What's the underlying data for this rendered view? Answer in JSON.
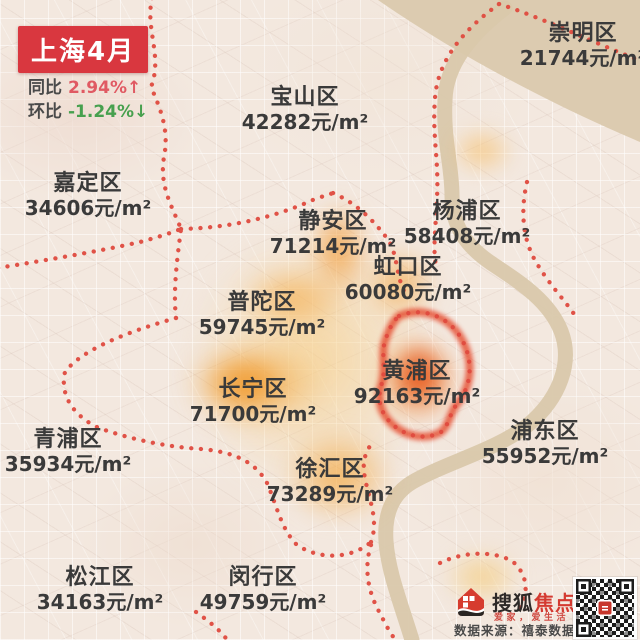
{
  "header": {
    "title": "上海4月",
    "yoy_label": "同比",
    "yoy_value": "2.94%↑",
    "mom_label": "环比",
    "mom_value": "-1.24%↓",
    "title_bg_color": "#d9373f",
    "yoy_color": "#e05a63",
    "mom_color": "#47a04e"
  },
  "map": {
    "unit": "元/m²",
    "boundary_dot_color": "#e04b3f",
    "heat_color": "#f0962e",
    "highlight_color": "#e5472a",
    "river_color": "#dccbb0",
    "districts": [
      {
        "name": "崇明区",
        "price": "21744元/m²"
      },
      {
        "name": "宝山区",
        "price": "42282元/m²"
      },
      {
        "name": "嘉定区",
        "price": "34606元/m²"
      },
      {
        "name": "静安区",
        "price": "71214元/m²"
      },
      {
        "name": "杨浦区",
        "price": "58408元/m²"
      },
      {
        "name": "虹口区",
        "price": "60080元/m²"
      },
      {
        "name": "普陀区",
        "price": "59745元/m²"
      },
      {
        "name": "黄浦区",
        "price": "92163元/m²"
      },
      {
        "name": "长宁区",
        "price": "71700元/m²"
      },
      {
        "name": "青浦区",
        "price": "35934元/m²"
      },
      {
        "name": "浦东区",
        "price": "55952元/m²"
      },
      {
        "name": "徐汇区",
        "price": "73289元/m²"
      },
      {
        "name": "松江区",
        "price": "34163元/m²"
      },
      {
        "name": "闵行区",
        "price": "49759元/m²"
      }
    ]
  },
  "footer": {
    "brand_black": "搜狐",
    "brand_red": "焦点",
    "tagline": "爱家，爱生活",
    "source": "数据来源：禧泰数据"
  }
}
